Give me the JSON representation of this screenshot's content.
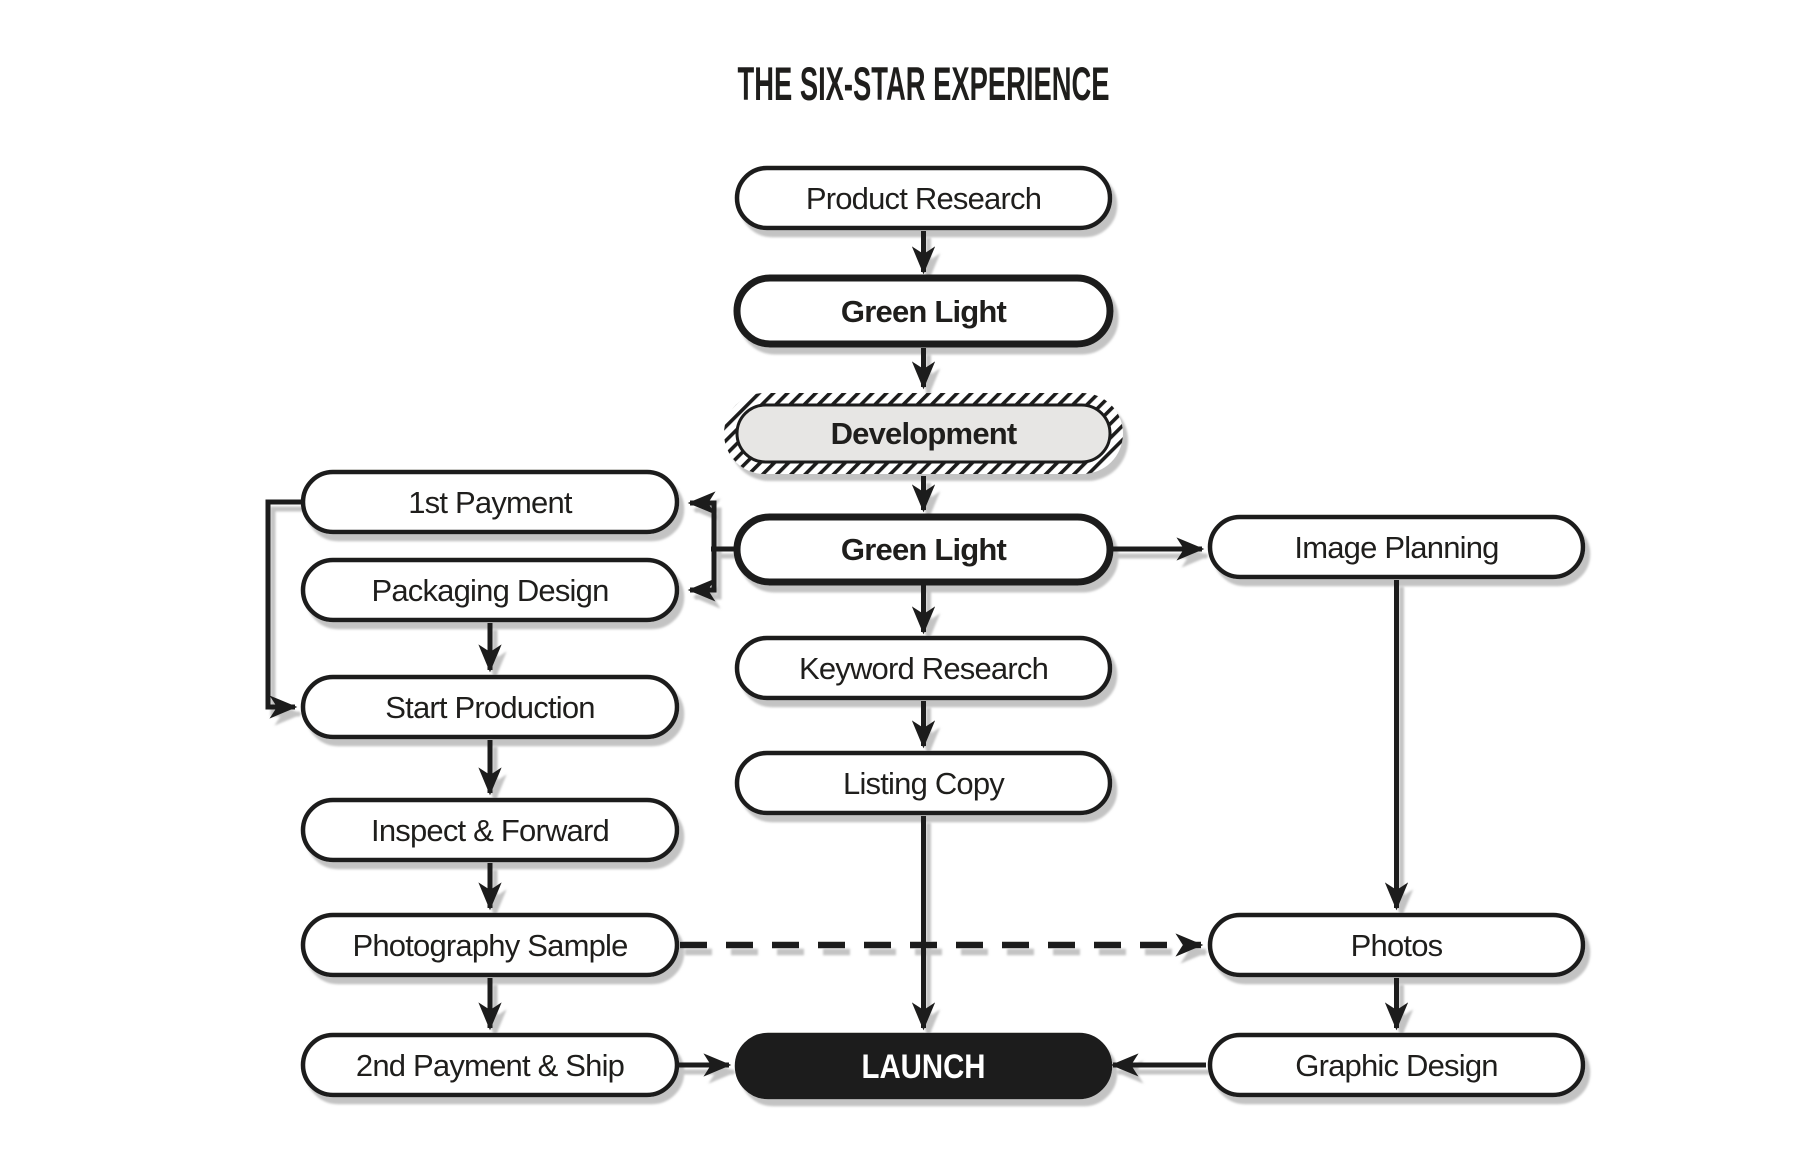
{
  "title": "THE SIX-STAR EXPERIENCE",
  "nodes": {
    "product_research": {
      "label": "Product Research",
      "emphasis": "normal"
    },
    "green_light_1": {
      "label": "Green Light",
      "emphasis": "strong-border"
    },
    "development": {
      "label": "Development",
      "emphasis": "hatched-gray"
    },
    "green_light_2": {
      "label": "Green Light",
      "emphasis": "strong-border"
    },
    "keyword_research": {
      "label": "Keyword Research",
      "emphasis": "normal"
    },
    "listing_copy": {
      "label": "Listing Copy",
      "emphasis": "normal"
    },
    "launch": {
      "label": "LAUNCH",
      "emphasis": "filled-black"
    },
    "first_payment": {
      "label": "1st Payment",
      "emphasis": "normal"
    },
    "packaging_design": {
      "label": "Packaging Design",
      "emphasis": "normal"
    },
    "start_production": {
      "label": "Start Production",
      "emphasis": "normal"
    },
    "inspect_and_forward": {
      "label": "Inspect & Forward",
      "emphasis": "normal"
    },
    "photography_sample": {
      "label": "Photography Sample",
      "emphasis": "normal"
    },
    "second_payment_and_ship": {
      "label": "2nd Payment & Ship",
      "emphasis": "normal"
    },
    "image_planning": {
      "label": "Image Planning",
      "emphasis": "normal"
    },
    "photos": {
      "label": "Photos",
      "emphasis": "normal"
    },
    "graphic_design": {
      "label": "Graphic Design",
      "emphasis": "normal"
    }
  },
  "edges": [
    {
      "from": "product_research",
      "to": "green_light_1",
      "style": "solid-arrow"
    },
    {
      "from": "green_light_1",
      "to": "development",
      "style": "solid-arrow"
    },
    {
      "from": "development",
      "to": "green_light_2",
      "style": "solid-arrow"
    },
    {
      "from": "green_light_2",
      "to": "first_payment",
      "style": "solid-arrow"
    },
    {
      "from": "green_light_2",
      "to": "packaging_design",
      "style": "solid-arrow"
    },
    {
      "from": "green_light_2",
      "to": "image_planning",
      "style": "solid-arrow"
    },
    {
      "from": "green_light_2",
      "to": "keyword_research",
      "style": "solid-arrow"
    },
    {
      "from": "keyword_research",
      "to": "listing_copy",
      "style": "solid-arrow"
    },
    {
      "from": "listing_copy",
      "to": "launch",
      "style": "solid-arrow"
    },
    {
      "from": "first_payment",
      "to": "start_production",
      "style": "solid-arrow"
    },
    {
      "from": "packaging_design",
      "to": "start_production",
      "style": "solid-arrow"
    },
    {
      "from": "start_production",
      "to": "inspect_and_forward",
      "style": "solid-arrow"
    },
    {
      "from": "inspect_and_forward",
      "to": "photography_sample",
      "style": "solid-arrow"
    },
    {
      "from": "photography_sample",
      "to": "second_payment_and_ship",
      "style": "solid-arrow"
    },
    {
      "from": "photography_sample",
      "to": "photos",
      "style": "dashed-arrow"
    },
    {
      "from": "second_payment_and_ship",
      "to": "launch",
      "style": "solid-arrow"
    },
    {
      "from": "image_planning",
      "to": "photos",
      "style": "solid-arrow"
    },
    {
      "from": "photos",
      "to": "graphic_design",
      "style": "solid-arrow"
    },
    {
      "from": "graphic_design",
      "to": "launch",
      "style": "solid-arrow"
    }
  ],
  "colors": {
    "ink": "#1f1e1c",
    "node_fill": "#ffffff",
    "development_fill": "#e7e6e4",
    "launch_fill": "#1f1e1c",
    "launch_text": "#ffffff",
    "shadow": "#bdbdbd",
    "background": "#ffffff"
  }
}
